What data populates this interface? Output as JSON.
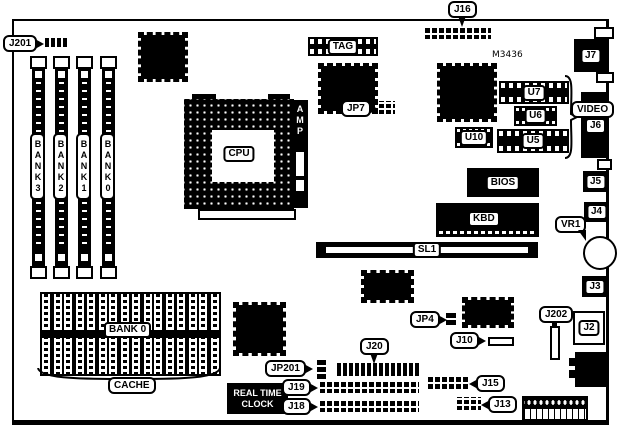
{
  "diagram": {
    "kind": "motherboard-layout"
  },
  "colors": {
    "ink": "#000000",
    "paper": "#ffffff"
  },
  "labels": {
    "j201": "J201",
    "j16": "J16",
    "jp7": "JP7",
    "vr1": "VR1",
    "j202": "J202",
    "jp4": "JP4",
    "j10": "J10",
    "j20": "J20",
    "jp201": "JP201",
    "j19": "J19",
    "j18": "J18",
    "j15": "J15",
    "j13": "J13",
    "tag": "TAG",
    "m3436": "M3436",
    "u7": "U7",
    "u6": "U6",
    "u10": "U10",
    "u5": "U5",
    "bios": "BIOS",
    "kbd": "KBD",
    "sl1": "SL1",
    "cpu": "CPU",
    "amp": "AMP",
    "video": "VIDEO",
    "j7": "J7",
    "j6": "J6",
    "j5": "J5",
    "j4": "J4",
    "j3": "J3",
    "j2": "J2",
    "bank3": "BANK3",
    "bank2": "BANK2",
    "bank1": "BANK1",
    "bank0": "BANK0",
    "cache_bank": "BANK 0",
    "cache": "CACHE",
    "rtc_line1": "REAL TIME",
    "rtc_line2": "CLOCK"
  }
}
